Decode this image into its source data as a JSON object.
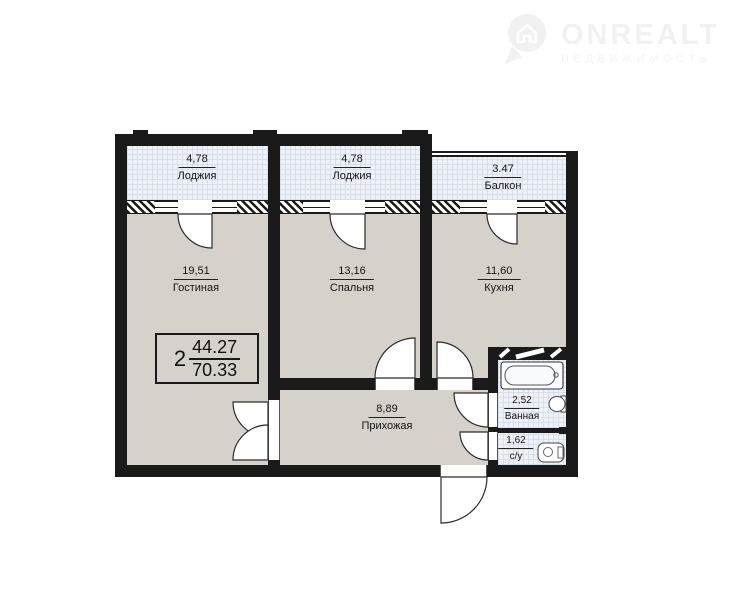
{
  "watermark": {
    "brand": "ONREALT",
    "tagline": "НЕДВИЖИМОСТЬ",
    "color": "#f1f1f1",
    "icon": "house-pin-icon"
  },
  "apartment": {
    "rooms_count": "2",
    "living_area": "44.27",
    "total_area": "70.33"
  },
  "rooms": [
    {
      "key": "loggia-1",
      "name": "Лоджия",
      "area": "4,78"
    },
    {
      "key": "loggia-2",
      "name": "Лоджия",
      "area": "4,78"
    },
    {
      "key": "balcony",
      "name": "Балкон",
      "area": "3.47"
    },
    {
      "key": "living",
      "name": "Гостиная",
      "area": "19,51"
    },
    {
      "key": "bedroom",
      "name": "Спальня",
      "area": "13,16"
    },
    {
      "key": "kitchen",
      "name": "Кухня",
      "area": "11,60"
    },
    {
      "key": "hallway",
      "name": "Прихожая",
      "area": "8,89"
    },
    {
      "key": "bathroom",
      "name": "Ванная",
      "area": "2,52"
    },
    {
      "key": "wc",
      "name": "с/у",
      "area": "1,62"
    }
  ],
  "fixtures": [
    "bathtub-icon",
    "sink-icon",
    "toilet-icon"
  ],
  "colors": {
    "wall": "#1a1a1a",
    "room_fill": "#d7d1cc",
    "cold_room_fill": "#eef2f8",
    "grid_line": "#d7dfe9"
  }
}
